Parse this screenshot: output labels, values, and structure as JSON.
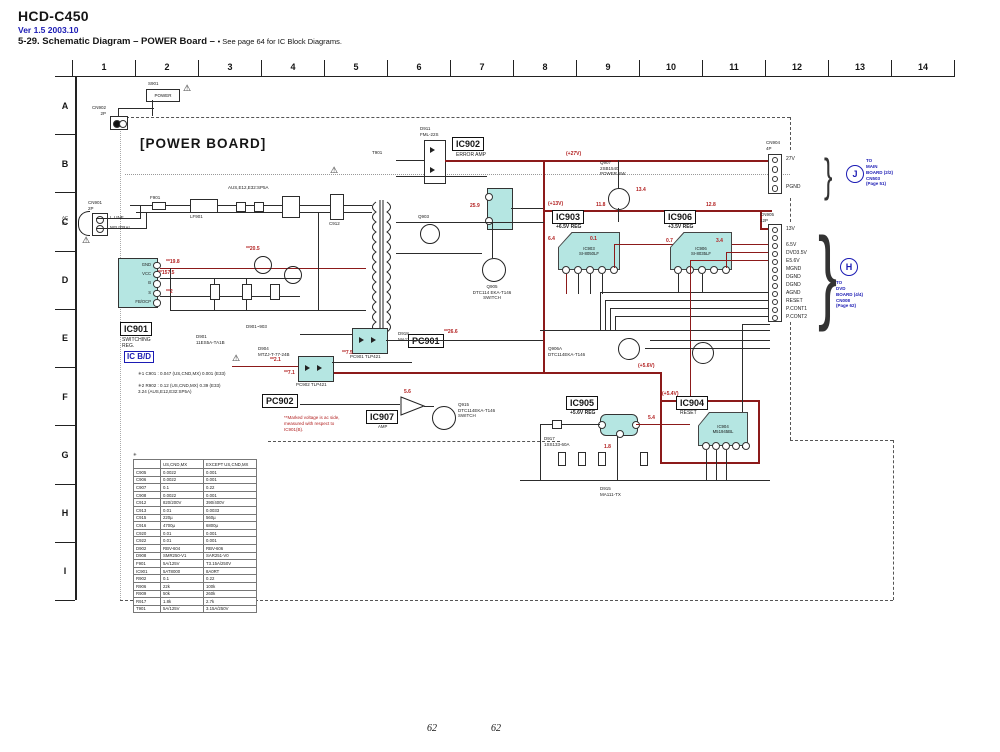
{
  "header": {
    "model": "HCD-C450",
    "version": "Ver 1.5  2003.10",
    "title": "5-29. Schematic Diagram  – POWER Board –",
    "note": "• See page 64 for IC Block Diagrams."
  },
  "grid": {
    "cols": [
      "1",
      "2",
      "3",
      "4",
      "5",
      "6",
      "7",
      "8",
      "9",
      "10",
      "11",
      "12",
      "13",
      "14"
    ],
    "rows": [
      "A",
      "B",
      "C",
      "D",
      "E",
      "F",
      "G",
      "H",
      "I"
    ]
  },
  "board": {
    "title": "[POWER BOARD]"
  },
  "labels": {
    "s901_ref": "S901",
    "s901": "POWER",
    "cn902": "CN902\n2P",
    "cn901": "CN901\n2P",
    "ac_in": "AC\nIN",
    "l_line": "L.LINE",
    "neutral": "NEUTRAL",
    "fuse_note": "AUS,E12,E32:SP5A",
    "f901": "F901",
    "lf901": "LF901",
    "t901": "T901",
    "d911": "D911\nFML-22S",
    "q907": "Q907\n2SB1540\nPOWER SW",
    "d901_903": "D901~903",
    "d901": "D901\n11ES5A-TA1B",
    "d904": "D904\nMTZJ-T-77-24B",
    "d918": "D918\nMA111-TX",
    "q903": "Q903",
    "q905": "Q905\nDTC114 EKA-T146\nSWITCH",
    "q906": "Q906A\nDTC114EKA-T146",
    "q915": "Q915\nDTC114EKA-T146\nSWITCH",
    "d917": "D917\n1SS133-60A",
    "d915": "D915\nMA111-TX",
    "cn904": "CN904\n4P",
    "cn905": "CN905\n12P",
    "c912": "C912"
  },
  "ic901": {
    "ref": "IC901",
    "sub": "SWITCHING\nREG.",
    "tag": "IC B/D",
    "pins": [
      "GND",
      "VCC",
      "B",
      "S",
      "FB/OCP"
    ]
  },
  "ic902": {
    "ref": "IC902",
    "sub": "ERROR AMP"
  },
  "ic903": {
    "ref": "IC903",
    "sub": "+6.5V REG",
    "chip": "IC903\nSI-8050LF"
  },
  "ic906": {
    "ref": "IC906",
    "sub": "+3.5V REG",
    "chip": "IC906\nSI-8035LF"
  },
  "ic904": {
    "ref": "IC904",
    "sub": "RESET",
    "chip": "IC904\nM51945BL"
  },
  "ic905": {
    "ref": "IC905",
    "sub": "+5.6V REG"
  },
  "ic907": {
    "ref": "IC907",
    "sub": "AMP"
  },
  "pc901": {
    "ref": "PC901",
    "part": "PC901 TLP421"
  },
  "pc902": {
    "ref": "PC902",
    "part": "PC902 TLP421"
  },
  "cn904_pins": [
    "27V",
    "",
    "",
    "PGND"
  ],
  "cn905_pins": [
    "13V",
    "",
    "6.5V",
    "DVD3.5V",
    "E5.6V",
    "MGND",
    "DGND",
    "DGND",
    "AGND",
    "RESET",
    "P.CONT1",
    "P.CONT2"
  ],
  "j_link": {
    "id": "J",
    "lines": [
      "TO",
      "MAIN",
      "BOARD (2/2)",
      "CN503",
      "(Page 51)"
    ]
  },
  "h_link": {
    "id": "H",
    "lines": [
      "TO",
      "DVD",
      "BOARD (4/4)",
      "CN008",
      "(Page 62)"
    ]
  },
  "rv": {
    "v27": "(+27V)",
    "v13": "(+13V)",
    "v56": "(+5.6V)",
    "v54": "(+5.4V)",
    "a": "**19.8",
    "b": "**157.5",
    "c": "**2",
    "d": "**20.5",
    "e": "25.9",
    "f": "11.8",
    "g": "12.8",
    "h": "6.4",
    "i": "0.1",
    "j": "0.7",
    "k": "3.4",
    "l": "**2.1",
    "m": "**7.1",
    "n": "**7.5",
    "o": "**26.6",
    "p": "5.6",
    "q": "5.4",
    "r": "13.4",
    "s": "1.8"
  },
  "footnotes": [
    "✳1  C901 : 0.047 (US,CND,MX)   0.001 (E33)",
    "✳2  R902 : 0.12 (US,CND,MX)   0.39 (E33)\n        3.24 (AUS,E12,E32:SP5A)"
  ],
  "red_note": "**Marked voltage is ac side,\nmeasured with respect to\nIC901(B).",
  "warning_icon": "⚠",
  "table": {
    "mark": "✳",
    "headers": [
      "",
      "US,CND,MX",
      "EXCEPT US,CND,MX"
    ],
    "rows": [
      [
        "C905",
        "0.0022",
        "0.001"
      ],
      [
        "C906",
        "0.0022",
        "0.001"
      ],
      [
        "C907",
        "0.1",
        "0.22"
      ],
      [
        "C908",
        "0.0022",
        "0.001"
      ],
      [
        "C912",
        "820/200V",
        "390/400V"
      ],
      [
        "C913",
        "0.01",
        "0.0033"
      ],
      [
        "C915",
        "220µ",
        "560µ"
      ],
      [
        "C916",
        "4700µ",
        "6800µ"
      ],
      [
        "C920",
        "0.01",
        "0.001"
      ],
      [
        "C922",
        "0.01",
        "0.001"
      ],
      [
        "D902",
        "RBV-604",
        "RBV-606"
      ],
      [
        "D908",
        "SMR250-V1",
        "SAR251-V0"
      ],
      [
        "F901",
        "5A/125V",
        "T3.15A/250V"
      ],
      [
        "IC901",
        "5AT8000",
        "8A0RT"
      ],
      [
        "R902",
        "0.1",
        "0.22"
      ],
      [
        "R906",
        "22k",
        "100k"
      ],
      [
        "R909",
        "50k",
        "260k"
      ],
      [
        "R917",
        "1.8k",
        "2.7k"
      ],
      [
        "T901",
        "5A/125V",
        "3.15A/250V"
      ]
    ]
  },
  "footer": {
    "page_left": "62",
    "page_right": "62"
  },
  "colors": {
    "accent_blue": "#1b1bb4",
    "wire_red": "#8c1a1a",
    "ic_fill": "#b5e6e2"
  }
}
